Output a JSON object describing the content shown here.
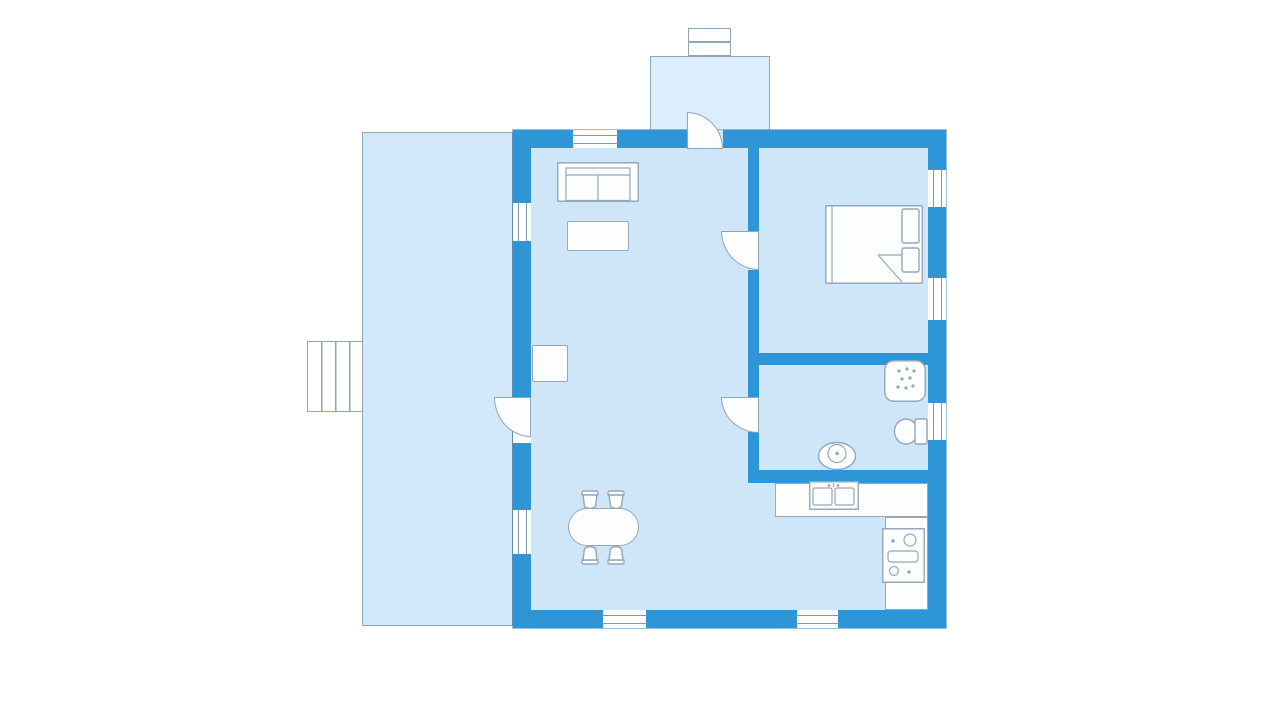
{
  "colors": {
    "background": "#ffffff",
    "wall": "#2e96d6",
    "room_fill": "#cfe6f8",
    "porch_fill": "#dcedfb",
    "deck_fill": "#d3e8f9",
    "fixture_fill": "#fcfdfd",
    "fixture_outline": "#96a7b6",
    "thin_outline": "#8fa5b8",
    "pane_line": "#7e99ad"
  },
  "fixtures": {
    "chimney": "chimney-icon",
    "entrance_porch": "entrance-porch",
    "front_door": "door-swing-icon",
    "deck": "deck-terrace",
    "stairs": "stairs-icon",
    "sofa": "sofa-icon",
    "coffee_table": "coffee-table-icon",
    "fireplace": "fireplace-icon",
    "bed": "double-bed-icon",
    "bedroom_door": "door-swing-icon",
    "bathroom_door": "door-swing-icon",
    "deck_door": "door-swing-icon",
    "shower": "shower-icon",
    "toilet": "toilet-icon",
    "wash_basin": "wash-basin-icon",
    "kitchen_sink": "double-sink-icon",
    "stove": "stove-icon",
    "kitchen_counter": "counter-top",
    "dining_table": "dining-table-icon",
    "dining_chairs": "chair-icon",
    "windows": "window-icon"
  }
}
